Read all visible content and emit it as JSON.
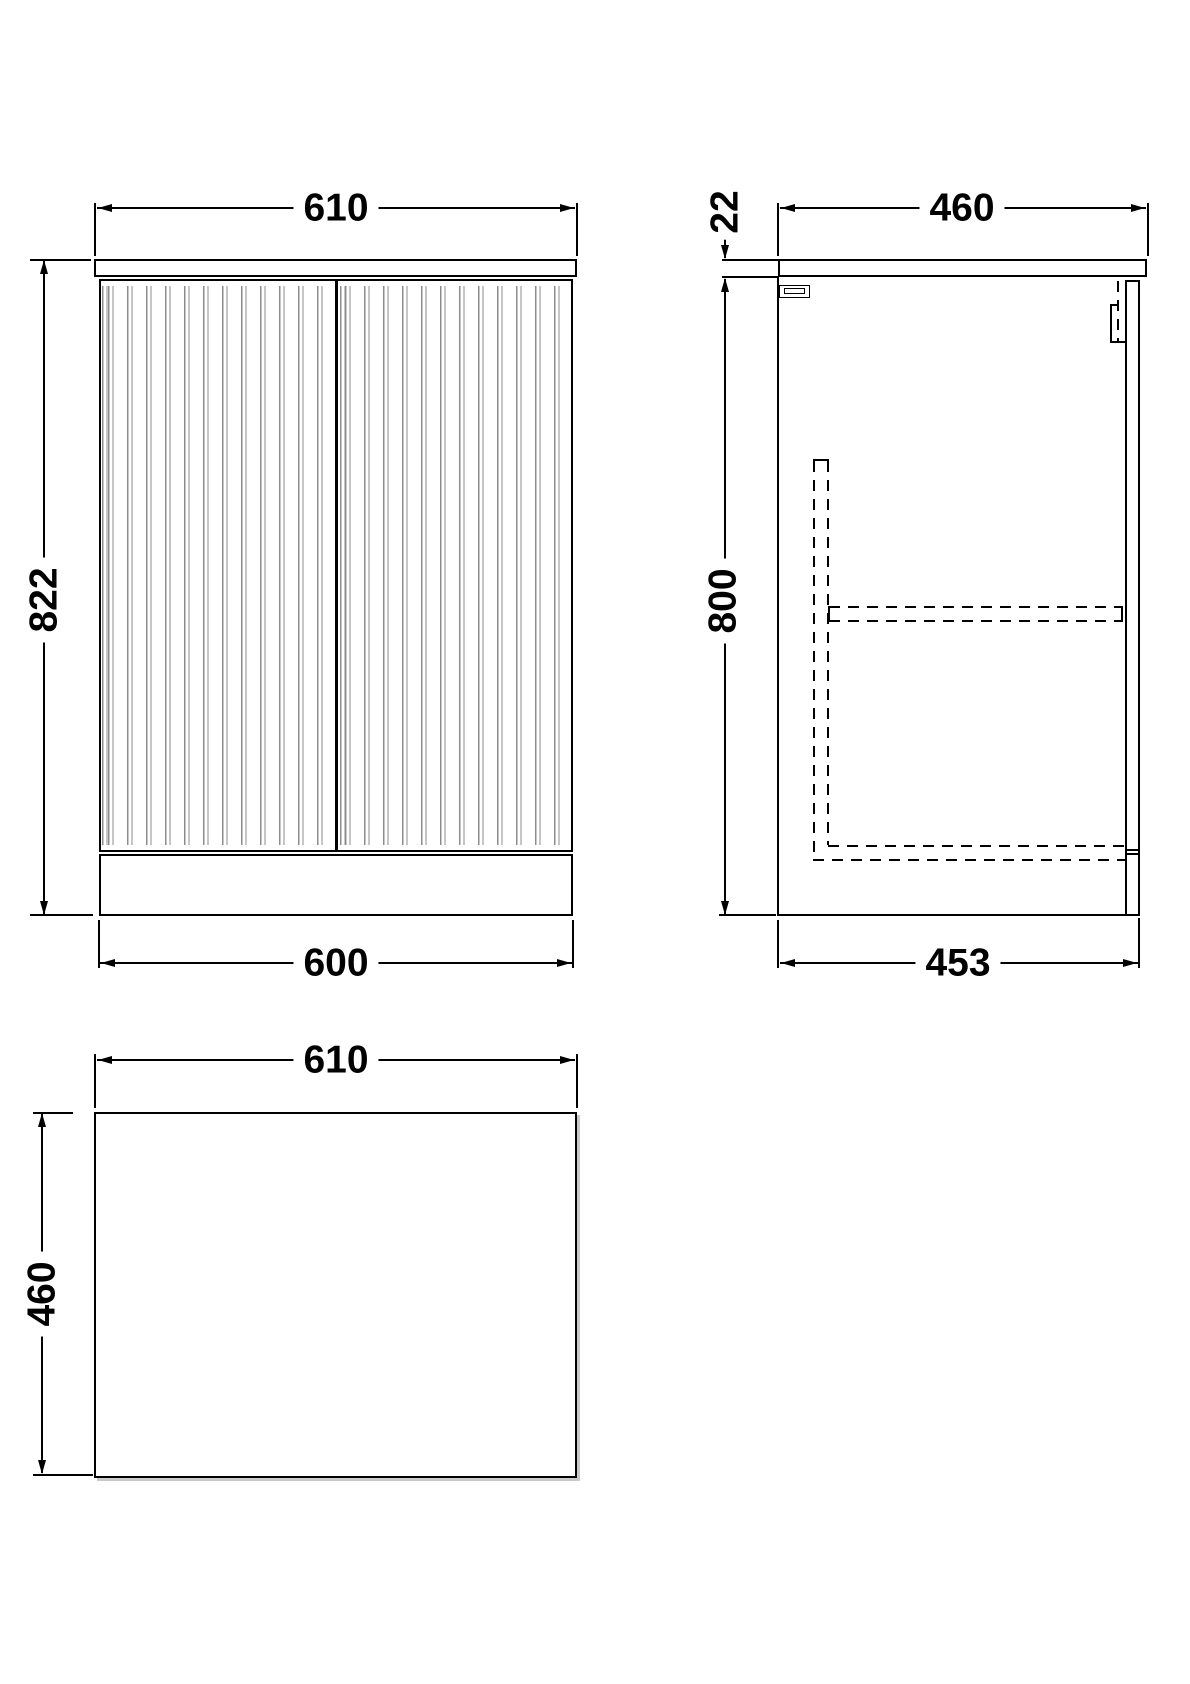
{
  "views": {
    "front": {
      "top_width": "610",
      "height": "822",
      "bottom_width": "600"
    },
    "side": {
      "top_depth": "460",
      "worktop_thickness": "22",
      "height": "800",
      "bottom_depth": "453"
    },
    "plan": {
      "width": "610",
      "depth": "460"
    }
  },
  "colors": {
    "line": "#000000",
    "flute": "#8c8c8c",
    "background": "#ffffff"
  }
}
